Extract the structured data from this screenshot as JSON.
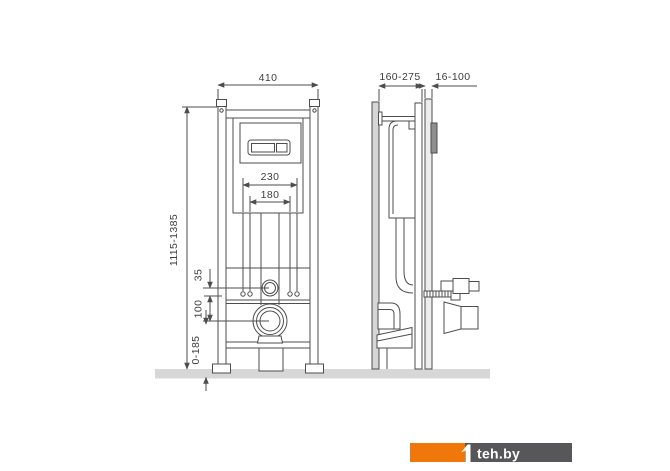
{
  "drawing": {
    "dimensions": {
      "front": {
        "overall_width": "410",
        "upper_stud_spacing": "230",
        "inner_stud_spacing": "180",
        "frame_height_range": "1115-1385",
        "inlet_to_fixing_offset": "35",
        "fixing_to_outlet_offset": "100",
        "foot_adjust_range": "0-185"
      },
      "side": {
        "installation_depth_range": "160-275",
        "wall_finish_range": "16-100"
      }
    },
    "colors": {
      "line": "#4D4D4D",
      "floor": "#D7D7D7",
      "wall": "#D6D6D6",
      "facing": "#EDEDED",
      "flush_plate_side": "#8F8F8F",
      "background": "#FFFFFF"
    }
  },
  "watermark": {
    "text": "teh.by",
    "accent_color": "#F0780A",
    "panel_color": "#57575A",
    "text_color": "#FFFFFF"
  }
}
